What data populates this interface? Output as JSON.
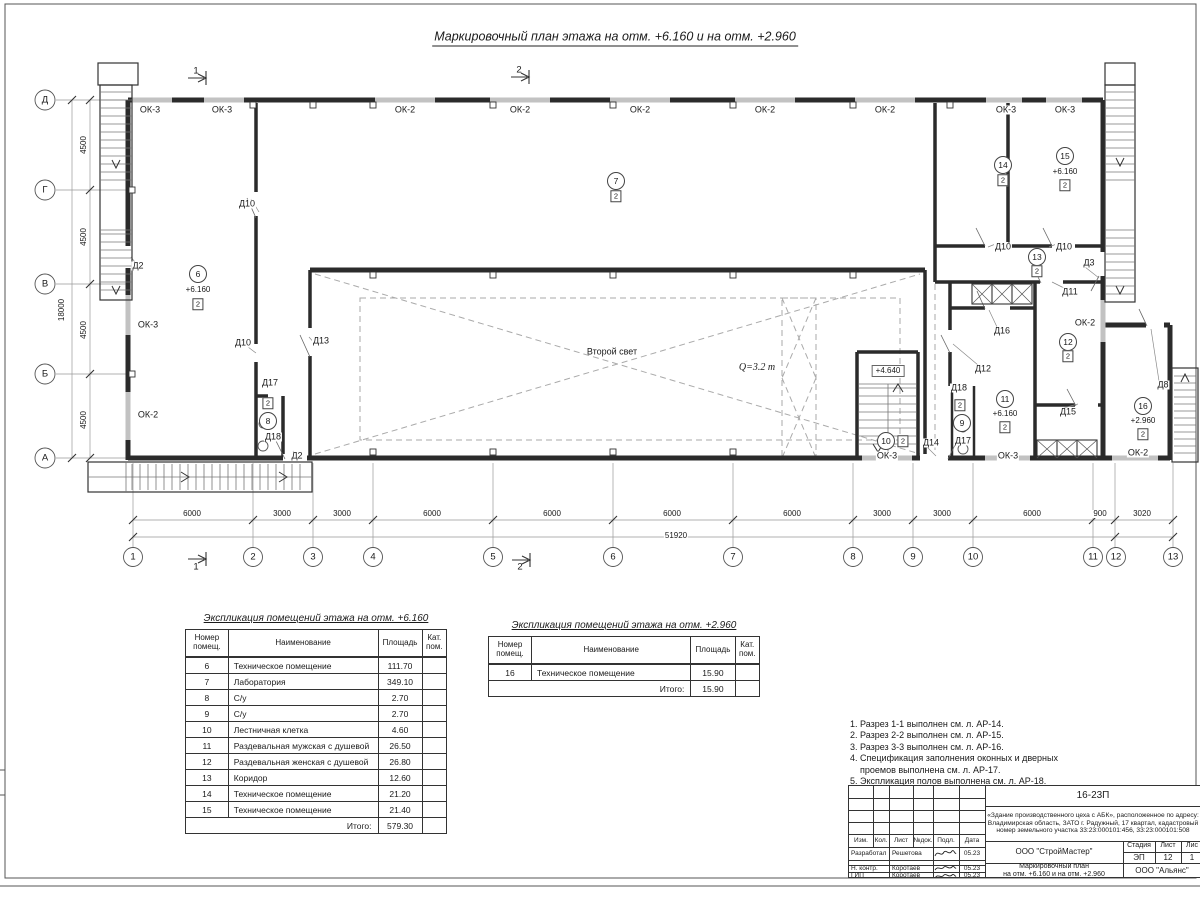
{
  "sheet": {
    "title": "Маркировочный план этажа на отм. +6.160 и на отм. +2.960"
  },
  "plan": {
    "labels": [
      {
        "t": "ОК-3",
        "x": 150,
        "y": 110,
        "c": "win"
      },
      {
        "t": "ОК-3",
        "x": 222,
        "y": 110,
        "c": "win"
      },
      {
        "t": "ОК-2",
        "x": 405,
        "y": 110,
        "c": "win"
      },
      {
        "t": "ОК-2",
        "x": 520,
        "y": 110,
        "c": "win"
      },
      {
        "t": "ОК-2",
        "x": 640,
        "y": 110,
        "c": "win"
      },
      {
        "t": "ОК-2",
        "x": 765,
        "y": 110,
        "c": "win"
      },
      {
        "t": "ОК-2",
        "x": 885,
        "y": 110,
        "c": "win"
      },
      {
        "t": "ОК-3",
        "x": 1006,
        "y": 110,
        "c": "win"
      },
      {
        "t": "ОК-3",
        "x": 1065,
        "y": 110,
        "c": "win"
      },
      {
        "t": "ОК-3",
        "x": 148,
        "y": 325,
        "c": "win"
      },
      {
        "t": "ОК-2",
        "x": 148,
        "y": 415,
        "c": "win"
      },
      {
        "t": "ОК-3",
        "x": 887,
        "y": 456,
        "c": "win"
      },
      {
        "t": "ОК-3",
        "x": 1008,
        "y": 456,
        "c": "win"
      },
      {
        "t": "ОК-2",
        "x": 1138,
        "y": 453,
        "c": "win"
      },
      {
        "t": "ОК-2",
        "x": 1085,
        "y": 323,
        "c": "win"
      },
      {
        "t": "Д2",
        "x": 138,
        "y": 266,
        "c": "door"
      },
      {
        "t": "Д2",
        "x": 297,
        "y": 456,
        "c": "door"
      },
      {
        "t": "Д10",
        "x": 247,
        "y": 204,
        "c": "door"
      },
      {
        "t": "Д10",
        "x": 243,
        "y": 343,
        "c": "door"
      },
      {
        "t": "Д13",
        "x": 321,
        "y": 341,
        "c": "door"
      },
      {
        "t": "Д17",
        "x": 270,
        "y": 383,
        "c": "door"
      },
      {
        "t": "Д18",
        "x": 273,
        "y": 437,
        "c": "door"
      },
      {
        "t": "Д14",
        "x": 931,
        "y": 443,
        "c": "door"
      },
      {
        "t": "Д17",
        "x": 963,
        "y": 441,
        "c": "door"
      },
      {
        "t": "Д18",
        "x": 959,
        "y": 388,
        "c": "door"
      },
      {
        "t": "Д12",
        "x": 983,
        "y": 369,
        "c": "door"
      },
      {
        "t": "Д16",
        "x": 1002,
        "y": 331,
        "c": "door"
      },
      {
        "t": "Д15",
        "x": 1068,
        "y": 412,
        "c": "door"
      },
      {
        "t": "Д11",
        "x": 1070,
        "y": 292,
        "c": "door"
      },
      {
        "t": "Д3",
        "x": 1089,
        "y": 263,
        "c": "door"
      },
      {
        "t": "Д8",
        "x": 1163,
        "y": 385,
        "c": "door"
      },
      {
        "t": "Д10",
        "x": 1003,
        "y": 247,
        "c": "door"
      },
      {
        "t": "Д10",
        "x": 1064,
        "y": 247,
        "c": "door"
      },
      {
        "t": "6",
        "x": 198,
        "y": 274,
        "c": "bubble"
      },
      {
        "t": "+6.160",
        "x": 198,
        "y": 290,
        "c": "elev"
      },
      {
        "t": "2",
        "x": 198,
        "y": 304,
        "c": "tag"
      },
      {
        "t": "7",
        "x": 616,
        "y": 181,
        "c": "bubble"
      },
      {
        "t": "2",
        "x": 616,
        "y": 196,
        "c": "tag"
      },
      {
        "t": "2",
        "x": 268,
        "y": 403,
        "c": "tag"
      },
      {
        "t": "8",
        "x": 268,
        "y": 421,
        "c": "bubble"
      },
      {
        "t": "2",
        "x": 960,
        "y": 405,
        "c": "tag"
      },
      {
        "t": "9",
        "x": 962,
        "y": 423,
        "c": "bubble"
      },
      {
        "t": "10",
        "x": 886,
        "y": 441,
        "c": "bubble"
      },
      {
        "t": "2",
        "x": 903,
        "y": 441,
        "c": "tag"
      },
      {
        "t": "11",
        "x": 1005,
        "y": 399,
        "c": "bubble"
      },
      {
        "t": "+6.160",
        "x": 1005,
        "y": 414,
        "c": "elev"
      },
      {
        "t": "2",
        "x": 1005,
        "y": 427,
        "c": "tag"
      },
      {
        "t": "12",
        "x": 1068,
        "y": 342,
        "c": "bubble"
      },
      {
        "t": "2",
        "x": 1068,
        "y": 356,
        "c": "tag"
      },
      {
        "t": "13",
        "x": 1037,
        "y": 257,
        "c": "bubble"
      },
      {
        "t": "2",
        "x": 1037,
        "y": 271,
        "c": "tag"
      },
      {
        "t": "14",
        "x": 1003,
        "y": 165,
        "c": "bubble"
      },
      {
        "t": "2",
        "x": 1003,
        "y": 180,
        "c": "tag"
      },
      {
        "t": "15",
        "x": 1065,
        "y": 156,
        "c": "bubble"
      },
      {
        "t": "+6.160",
        "x": 1065,
        "y": 172,
        "c": "elev"
      },
      {
        "t": "2",
        "x": 1065,
        "y": 185,
        "c": "tag"
      },
      {
        "t": "16",
        "x": 1143,
        "y": 406,
        "c": "bubble"
      },
      {
        "t": "+2.960",
        "x": 1143,
        "y": 421,
        "c": "elev"
      },
      {
        "t": "2",
        "x": 1143,
        "y": 434,
        "c": "tag"
      },
      {
        "t": "Второй свет",
        "x": 612,
        "y": 352,
        "c": "txt"
      },
      {
        "t": "Q=3.2 т",
        "x": 757,
        "y": 368,
        "c": "crane"
      },
      {
        "t": "+4.640",
        "x": 888,
        "y": 371,
        "c": "elevbox"
      },
      {
        "t": "1",
        "x": 196,
        "y": 71,
        "c": "sect"
      },
      {
        "t": "2",
        "x": 519,
        "y": 70,
        "c": "sect"
      },
      {
        "t": "1",
        "x": 196,
        "y": 567,
        "c": "sect"
      },
      {
        "t": "2",
        "x": 520,
        "y": 567,
        "c": "sect"
      },
      {
        "t": "6000",
        "x": 192,
        "y": 514,
        "c": "dim"
      },
      {
        "t": "3000",
        "x": 282,
        "y": 514,
        "c": "dim"
      },
      {
        "t": "3000",
        "x": 342,
        "y": 514,
        "c": "dim"
      },
      {
        "t": "6000",
        "x": 432,
        "y": 514,
        "c": "dim"
      },
      {
        "t": "6000",
        "x": 552,
        "y": 514,
        "c": "dim"
      },
      {
        "t": "6000",
        "x": 672,
        "y": 514,
        "c": "dim"
      },
      {
        "t": "6000",
        "x": 792,
        "y": 514,
        "c": "dim"
      },
      {
        "t": "3000",
        "x": 882,
        "y": 514,
        "c": "dim"
      },
      {
        "t": "3000",
        "x": 942,
        "y": 514,
        "c": "dim"
      },
      {
        "t": "6000",
        "x": 1032,
        "y": 514,
        "c": "dim"
      },
      {
        "t": "900",
        "x": 1100,
        "y": 514,
        "c": "dim"
      },
      {
        "t": "3020",
        "x": 1142,
        "y": 514,
        "c": "dim"
      },
      {
        "t": "51920",
        "x": 676,
        "y": 536,
        "c": "dim"
      },
      {
        "t": "4500",
        "x": 84,
        "y": 145,
        "c": "dimv"
      },
      {
        "t": "4500",
        "x": 84,
        "y": 237,
        "c": "dimv"
      },
      {
        "t": "4500",
        "x": 84,
        "y": 330,
        "c": "dimv"
      },
      {
        "t": "4500",
        "x": 84,
        "y": 420,
        "c": "dimv"
      },
      {
        "t": "18000",
        "x": 62,
        "y": 310,
        "c": "dimv"
      },
      {
        "t": "1",
        "x": 133,
        "y": 557,
        "c": "axis"
      },
      {
        "t": "2",
        "x": 253,
        "y": 557,
        "c": "axis"
      },
      {
        "t": "3",
        "x": 313,
        "y": 557,
        "c": "axis"
      },
      {
        "t": "4",
        "x": 373,
        "y": 557,
        "c": "axis"
      },
      {
        "t": "5",
        "x": 493,
        "y": 557,
        "c": "axis"
      },
      {
        "t": "6",
        "x": 613,
        "y": 557,
        "c": "axis"
      },
      {
        "t": "7",
        "x": 733,
        "y": 557,
        "c": "axis"
      },
      {
        "t": "8",
        "x": 853,
        "y": 557,
        "c": "axis"
      },
      {
        "t": "9",
        "x": 913,
        "y": 557,
        "c": "axis"
      },
      {
        "t": "10",
        "x": 973,
        "y": 557,
        "c": "axis"
      },
      {
        "t": "11",
        "x": 1093,
        "y": 557,
        "c": "axis"
      },
      {
        "t": "12",
        "x": 1116,
        "y": 557,
        "c": "axis"
      },
      {
        "t": "13",
        "x": 1173,
        "y": 557,
        "c": "axis"
      },
      {
        "t": "Д",
        "x": 45,
        "y": 100,
        "c": "axis"
      },
      {
        "t": "Г",
        "x": 45,
        "y": 190,
        "c": "axis"
      },
      {
        "t": "В",
        "x": 45,
        "y": 284,
        "c": "axis"
      },
      {
        "t": "Б",
        "x": 45,
        "y": 374,
        "c": "axis"
      },
      {
        "t": "А",
        "x": 45,
        "y": 458,
        "c": "axis"
      }
    ]
  },
  "table_6160": {
    "title": "Экспликация помещений этажа на отм. +6.160",
    "headers": [
      "Номер помещ.",
      "Наименование",
      "Площадь",
      "Кат. пом."
    ],
    "rows": [
      [
        "6",
        "Техническое помещение",
        "111.70",
        ""
      ],
      [
        "7",
        "Лаборатория",
        "349.10",
        ""
      ],
      [
        "8",
        "С/у",
        "2.70",
        ""
      ],
      [
        "9",
        "С/у",
        "2.70",
        ""
      ],
      [
        "10",
        "Лестничная клетка",
        "4.60",
        ""
      ],
      [
        "11",
        "Раздевальная мужская с душевой",
        "26.50",
        ""
      ],
      [
        "12",
        "Раздевальная женская с душевой",
        "26.80",
        ""
      ],
      [
        "13",
        "Коридор",
        "12.60",
        ""
      ],
      [
        "14",
        "Техническое помещение",
        "21.20",
        ""
      ],
      [
        "15",
        "Техническое помещение",
        "21.40",
        ""
      ]
    ],
    "total_label": "Итого:",
    "total": "579.30"
  },
  "table_2960": {
    "title": "Экспликация помещений этажа на отм. +2.960",
    "headers": [
      "Номер помещ.",
      "Наименование",
      "Площадь",
      "Кат. пом."
    ],
    "rows": [
      [
        "16",
        "Техническое помещение",
        "15.90",
        ""
      ]
    ],
    "total_label": "Итого:",
    "total": "15.90"
  },
  "notes": [
    "1. Разрез 1-1 выполнен см. л. АР-14.",
    "2. Разрез 2-2 выполнен см. л. АР-15.",
    "3. Разрез 3-3 выполнен см. л. АР-16.",
    "4. Спецификация заполнения оконных и дверных",
    "    проемов выполнена см. л. АР-17.",
    "5. Экспликация полов выполнена см. л. АР-18."
  ],
  "titleblock": {
    "doc_number": "16-23П",
    "project": "«Здание производственного цеха с АБК», расположенное по адресу: Владимирская область, ЗАТО г. Радужный, 17 квартал, кадастровый номер земельного участка 33:23:000101:456, 33:23:000101:508",
    "cols": {
      "izm": "Изм.",
      "kol": "Кол.",
      "list": "Лист",
      "ndok": "№док.",
      "podp": "Подл.",
      "data": "Дата"
    },
    "rows": [
      {
        "role": "Разработал",
        "name": "Решетова",
        "date": "05.23"
      },
      {
        "role": "Н. контр.",
        "name": "Коротаев",
        "date": "05.23"
      },
      {
        "role": "ГИП",
        "name": "Коротаев",
        "date": "05.23"
      }
    ],
    "org": "ООО \"СтройМастер\"",
    "stage_label": "Стадия",
    "sheet_label": "Лист",
    "sheets_label": "Лис",
    "stage": "ЭП",
    "sheet_num": "12",
    "sheets_num": "1",
    "title_line1": "Маркировочный план",
    "title_line2": "на отм. +6.160 и на отм. +2.960",
    "client": "ООО \"Альянс\""
  }
}
